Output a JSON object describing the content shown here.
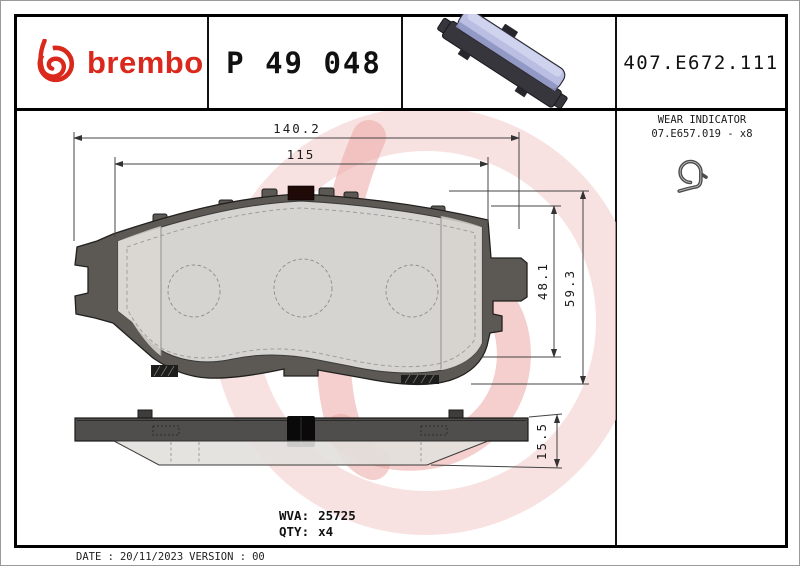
{
  "header": {
    "brand": "brembo",
    "part_number": "P 49 048",
    "catalog_number": "407.E672.111"
  },
  "wear_indicator": {
    "title": "WEAR INDICATOR",
    "code": "07.E657.019 - x8"
  },
  "dimensions": {
    "overall_width": "140.2",
    "pad_width": "115",
    "pad_height": "48.1",
    "overall_height": "59.3",
    "thickness": "15.5"
  },
  "footer": {
    "wva_label": "WVA:",
    "wva_value": "25725",
    "qty_label": "QTY:",
    "qty_value": "x4",
    "date_label": "DATE :",
    "date_value": "20/11/2023",
    "version_label": "VERSION :",
    "version_value": "00"
  },
  "colors": {
    "brand_red": "#da291c",
    "watermark_pink": "#f4d0ce",
    "watermark_salmon": "#eba8a4",
    "backplate_gray": "#5c5955",
    "friction_gray": "#e7e5e2",
    "pad_lavender": "#b9bee0"
  }
}
